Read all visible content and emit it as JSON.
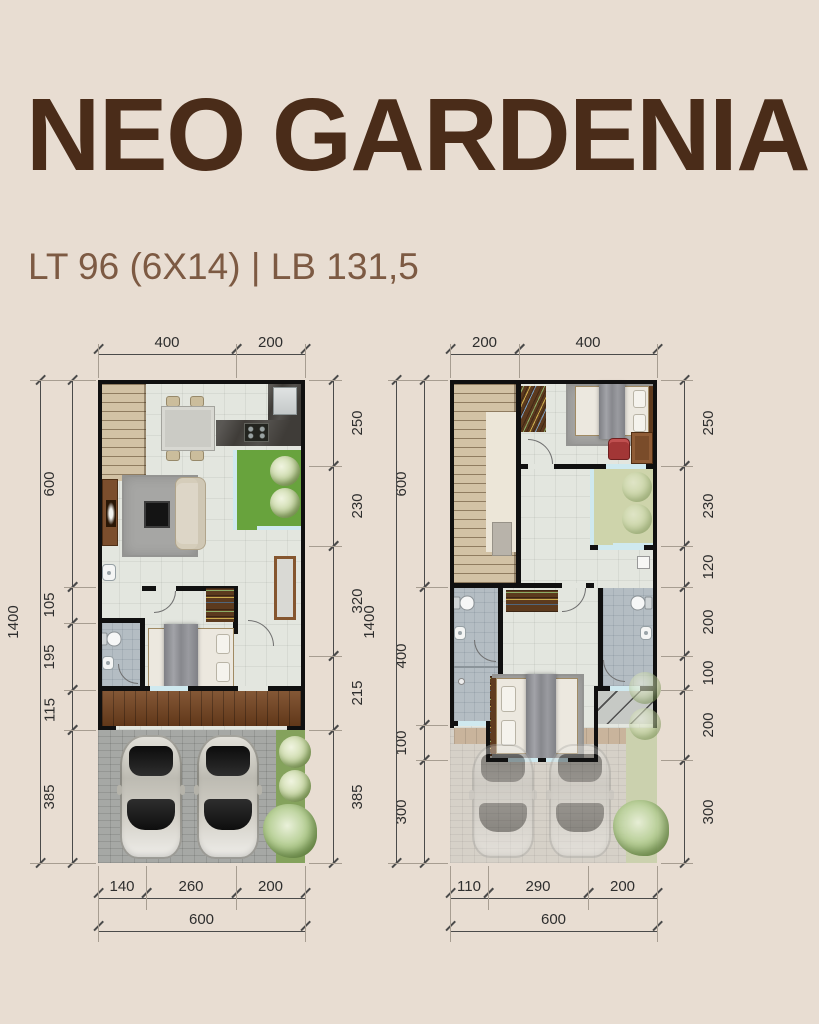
{
  "page": {
    "background": "#e8ddd2"
  },
  "header": {
    "title": "NEO GARDENIA",
    "subtitle": "LT 96 (6X14) | LB 131,5",
    "title_color": "#4a2c19",
    "subtitle_color": "#7d5a43"
  },
  "plans": [
    {
      "label": "ground-floor",
      "top_dims": [
        "400",
        "200"
      ],
      "right_dims": [
        "250",
        "230",
        "320",
        "215",
        "385"
      ],
      "left_dims": [
        "600",
        "105",
        "195",
        "115",
        "385"
      ],
      "left_total": "1400",
      "bottom_dims": [
        "140",
        "260",
        "200"
      ],
      "bottom_total": "600"
    },
    {
      "label": "upper-floor",
      "top_dims": [
        "200",
        "400"
      ],
      "right_dims": [
        "250",
        "230",
        "120",
        "200",
        "100",
        "200",
        "300"
      ],
      "left_dims": [
        "600",
        "400",
        "100",
        "300"
      ],
      "left_total": "1400",
      "bottom_dims": [
        "110",
        "290",
        "200"
      ],
      "bottom_total": "600"
    }
  ]
}
